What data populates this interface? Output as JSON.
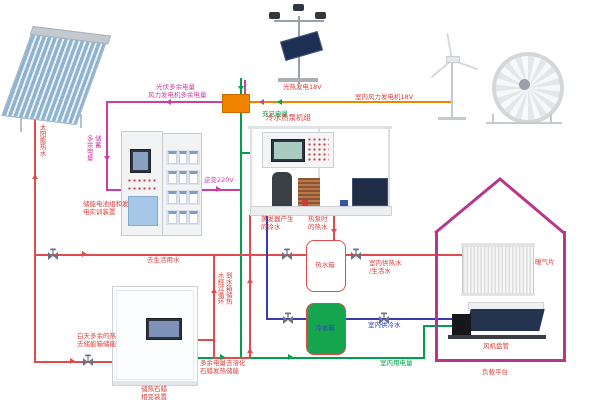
{
  "palette": {
    "magenta": "#cc3fa0",
    "orange": "#f08300",
    "green": "#00a14b",
    "red_line": "#e14b4b",
    "red_text": "#d8403c",
    "blue_line": "#3b3bb0",
    "blue_text": "#2a41c8",
    "house": "#b8368e",
    "tank_green": "#14a54e"
  },
  "labels": {
    "solar_hot_water": "太阳能热水",
    "pv_surplus": "光伏多余电量",
    "wind_surplus": "风力发电机多余电量",
    "pv_generation": "光热发电18V",
    "indoor_wind_generation": "室内风力发电机18V",
    "sufficient_power": "充足电量",
    "surplus_storage": "多余电量储蓄",
    "storage_training_device": "储能电池组和发\n电实训装置",
    "inverter_220v": "逆变220V",
    "heat_pump_unit": "冷水热泵机组",
    "evaporator_chilled_water": "蒸发器产生\n的冷水",
    "heat_pump_hot_water": "热泵时\n的热水",
    "hot_water_tank": "热水箱",
    "cold_water_tank": "冷水箱",
    "to_domestic_water": "去生活用水",
    "daytime_surplus_heat": "白天多余的热\n去储能箱储能",
    "paraffin_device": "储热石蜡\n相变装置",
    "water_circulation": "水经过循环\n到水箱储热",
    "surplus_melt_paraffin": "多余电量去溶化\n石蜡发热储能",
    "indoor_power_use": "室内用电量",
    "indoor_hot_supply": "室内供热水\n/生活水",
    "indoor_cold_supply": "室内供冷水",
    "radiator": "暖气片",
    "fan_coil": "风机盘管",
    "load_platform": "负载平台"
  }
}
